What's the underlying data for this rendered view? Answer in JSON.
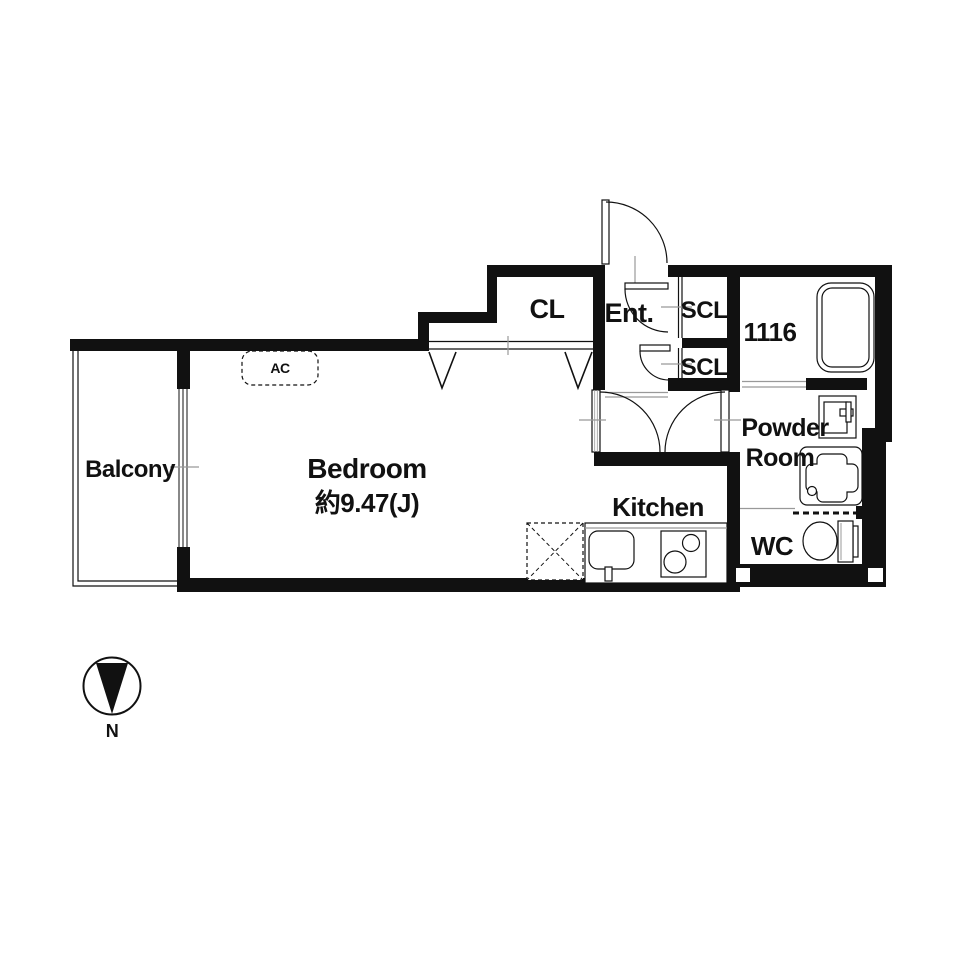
{
  "plan_title": "apartment-floor-plan",
  "rooms": {
    "balcony": "Balcony",
    "bedroom": "Bedroom",
    "bedroom_size": "約9.47(J)",
    "closet": "CL",
    "entrance": "Ent.",
    "shoe_closet_upper": "SCL",
    "shoe_closet_lower": "SCL",
    "bath": "1116",
    "powder_line1": "Powder",
    "powder_line2": "Room",
    "kitchen": "Kitchen",
    "wc": "WC"
  },
  "annotations": {
    "ac_unit": "AC",
    "compass_north": "N"
  },
  "colors": {
    "wall": "#111111",
    "thin_line": "#111111",
    "leader_line": "#999999",
    "background": "#ffffff"
  }
}
